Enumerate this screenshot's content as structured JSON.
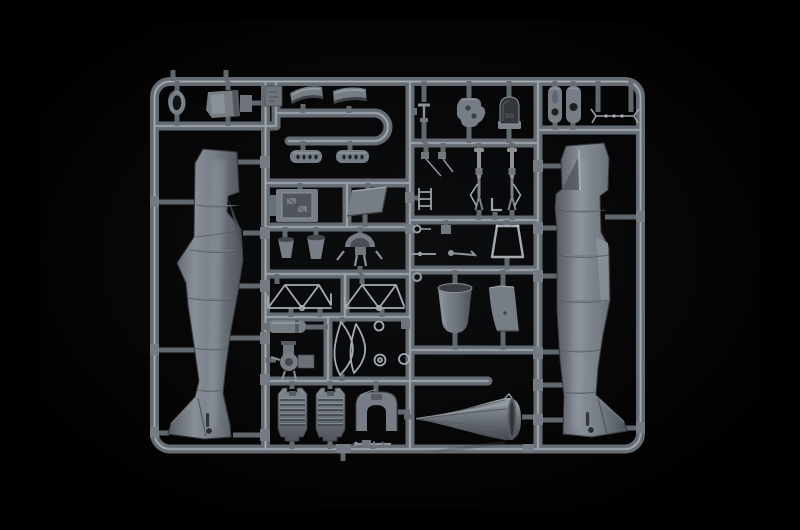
{
  "image": {
    "kind": "photograph",
    "subject": "plastic model kit sprue with aircraft fuselage halves and detail parts on a black background"
  },
  "palette": {
    "background": "#000000",
    "backdrop_glow": "#0d0e10",
    "runner_base": "#646b72",
    "runner_highlight": "#9aa1a9",
    "runner_highlight2": "#c2c8ce",
    "gate_block": "#747b82",
    "part_base": "#767d85",
    "part_light": "#a4abb2",
    "part_dark": "#4a4f55",
    "part_deep": "#2b2e32",
    "fuselage_light": "#8b9199",
    "fuselage_dark": "#565b62"
  },
  "parts": {
    "left_fuselage": "left fuselage half",
    "right_fuselage": "right fuselage half",
    "cowl_panels": "engine cowling panels (2)",
    "exhaust_shrouds": "slotted exhaust shrouds (2)",
    "oval_frame": "oval former ring",
    "cockpit_tub": "cockpit tub box",
    "radiator": "radiator housing",
    "access_panel": "access panel",
    "seat_buckets": "seat buckets (2)",
    "tailwheel_assembly": "tail wheel strut assembly",
    "engine_bearers": "engine bearer trusses (2)",
    "oil_tank": "oil tank cylinder",
    "pump_assembly": "fuel pump assembly",
    "curved_frames": "curved frame members",
    "engine_blocks": "V-12 engine block halves (2)",
    "firewall": "horseshoe firewall bulkhead",
    "machine_gun": "machine gun part",
    "control_column": "control column",
    "instrument_panel": "instrument panel",
    "head_armor": "head armor plate",
    "gear_struts": "main landing gear struts (2)",
    "small_linkages": "small linkage and lever parts",
    "windscreen_frame": "windscreen frame",
    "cowl_cup": "cowling cup",
    "wing_fillet": "wing fillet panel",
    "intake_cone": "fluted supercharger intake cone",
    "hub_plates": "oval hub plates (2)",
    "elevator_linkage": "elevator control linkage",
    "number_tag": "part number tag"
  }
}
